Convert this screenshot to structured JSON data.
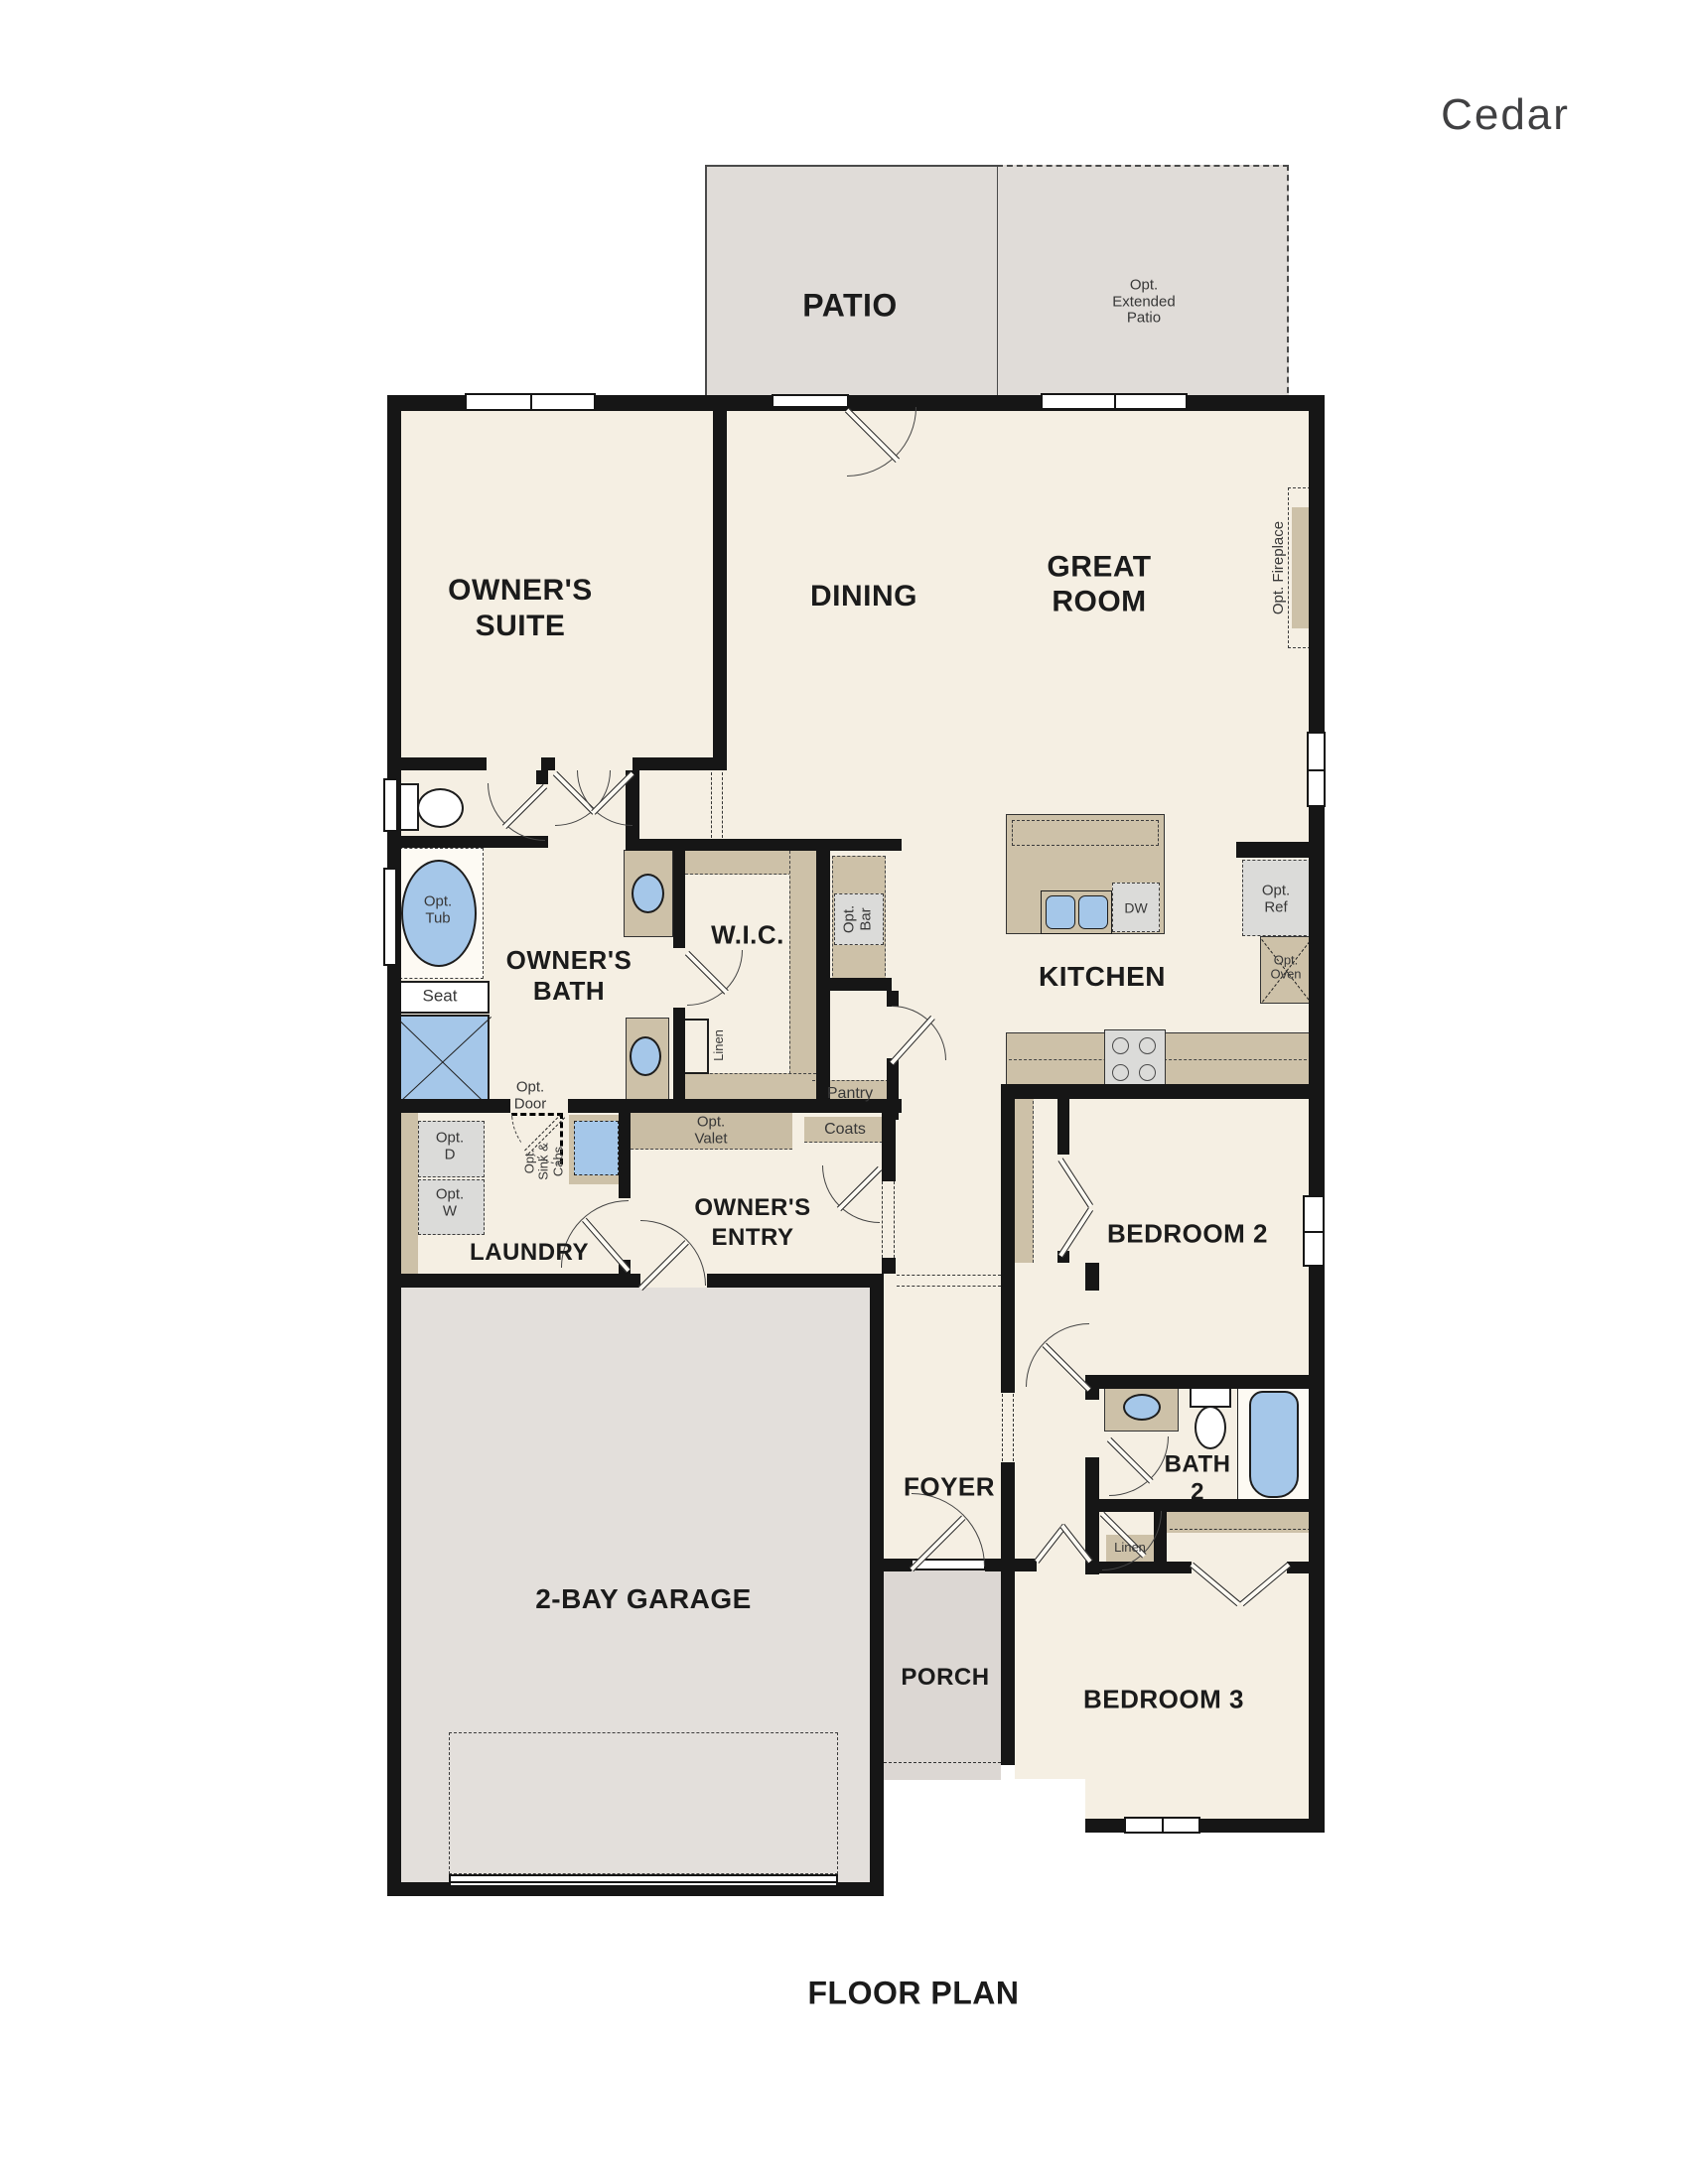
{
  "title": "Cedar",
  "caption": "FLOOR PLAN",
  "colors": {
    "floor": "#f5efe3",
    "patio_grey": "#e0dcd8",
    "garage_grey": "#e3dfdb",
    "porch_grey": "#dcd7d3",
    "counter_tan": "#cdc1a8",
    "fixture_blue": "#a5c7e9",
    "appliance_grey": "#dbdbd9",
    "wall_black": "#161616"
  },
  "rooms": {
    "patio": "PATIO",
    "owners_suite_l1": "OWNER'S",
    "owners_suite_l2": "SUITE",
    "dining": "DINING",
    "great_room_l1": "GREAT",
    "great_room_l2": "ROOM",
    "owners_bath_l1": "OWNER'S",
    "owners_bath_l2": "BATH",
    "wic": "W.I.C.",
    "kitchen": "KITCHEN",
    "laundry": "LAUNDRY",
    "owners_entry_l1": "OWNER'S",
    "owners_entry_l2": "ENTRY",
    "bedroom2": "BEDROOM 2",
    "bath2_l1": "BATH",
    "bath2_l2": "2",
    "foyer": "FOYER",
    "garage": "2-BAY GARAGE",
    "porch": "PORCH",
    "bedroom3": "BEDROOM 3"
  },
  "features": {
    "ext_patio_l1": "Opt.",
    "ext_patio_l2": "Extended",
    "ext_patio_l3": "Patio",
    "opt_fireplace": "Opt. Fireplace",
    "opt_tub_l1": "Opt.",
    "opt_tub_l2": "Tub",
    "seat": "Seat",
    "linen_wic": "Linen",
    "opt_bar_l1": "Opt.",
    "opt_bar_l2": "Bar",
    "dw": "DW",
    "opt_ref_l1": "Opt.",
    "opt_ref_l2": "Ref",
    "opt_oven_l1": "Opt.",
    "opt_oven_l2": "Oven",
    "pantry": "Pantry",
    "coats": "Coats",
    "opt_valet_l1": "Opt.",
    "opt_valet_l2": "Valet",
    "opt_door_l1": "Opt.",
    "opt_door_l2": "Door",
    "opt_d_l1": "Opt.",
    "opt_d_l2": "D",
    "opt_w_l1": "Opt.",
    "opt_w_l2": "W",
    "opt_sink_l1": "Opt.",
    "opt_sink_l2": "Sink &",
    "opt_sink_l3": "Cabs",
    "linen_bath2": "Linen"
  }
}
